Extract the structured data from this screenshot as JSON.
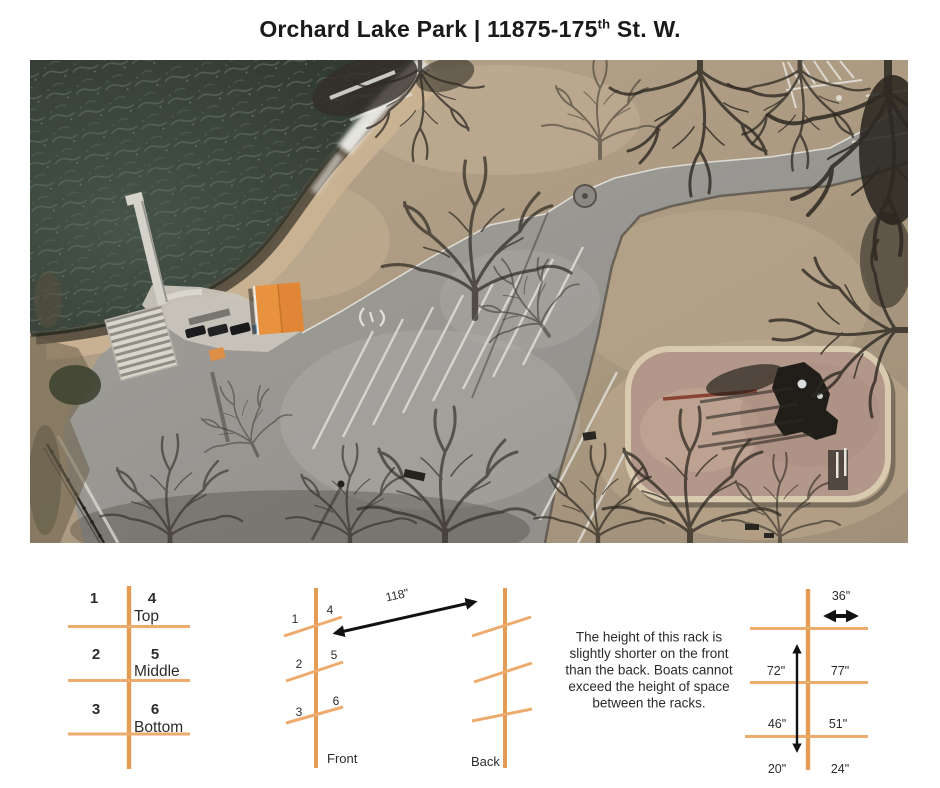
{
  "title": {
    "text": "Orchard Lake Park | 11875-175",
    "ordinal": "th",
    "suffix": " St. W."
  },
  "colors": {
    "rack_orange": "#E49B53",
    "rack_orange_light": "#EDAB6E",
    "text_dark": "#2B2B2B",
    "pavilion_orange": "#E8913F"
  },
  "position_key": {
    "slots": [
      {
        "left": "1",
        "right": "4",
        "label": "Top"
      },
      {
        "left": "2",
        "right": "5",
        "label": "Middle"
      },
      {
        "left": "3",
        "right": "6",
        "label": "Bottom"
      }
    ]
  },
  "side_view": {
    "front_label": "Front",
    "back_label": "Back",
    "spacing_label": "118\"",
    "front_slots": [
      {
        "left": "1",
        "right": "4"
      },
      {
        "left": "2",
        "right": "5"
      },
      {
        "left": "3",
        "right": "6"
      }
    ]
  },
  "note_lines": [
    "The height of this rack is",
    "slightly shorter on the front",
    "than the back. Boats cannot",
    "exceed the height of space",
    "between the racks."
  ],
  "height_view": {
    "top_width": "36\"",
    "rows": [
      {
        "front": "72\"",
        "back": "77\""
      },
      {
        "front": "46\"",
        "back": "51\""
      },
      {
        "front": "20\"",
        "back": "24\""
      }
    ]
  }
}
